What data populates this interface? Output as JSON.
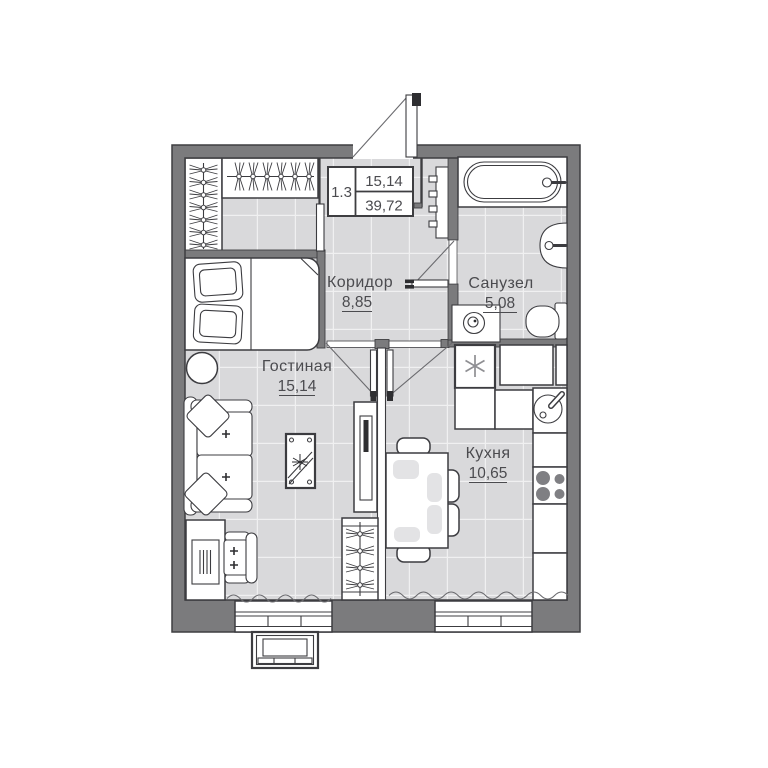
{
  "title": "Apartment floor plan 1.3",
  "stamp": {
    "unit": "1.3",
    "room_area": "15,14",
    "total_area": "39,72"
  },
  "rooms": {
    "corridor": {
      "name": "Коридор",
      "area": "8,85"
    },
    "bathroom": {
      "name": "Санузел",
      "area": "5,08"
    },
    "living_room": {
      "name": "Гостиная",
      "area": "15,14"
    },
    "kitchen": {
      "name": "Кухня",
      "area": "10,65"
    }
  },
  "colors": {
    "wall": "#7b7b7d",
    "wall_outline": "#3e3e41",
    "floor": "#d9d9db",
    "floor_grid": "#ffffff",
    "furniture_fill": "#ffffff",
    "furniture_outline": "#3c3c40",
    "placemat": "#e3e3e5",
    "handle_dark": "#2e2e31",
    "text": "#4b4b4f",
    "background": "#ffffff"
  },
  "furniture_icons": [
    "entrance-door",
    "coat-wardrobe",
    "hanger-closet",
    "ladder-rack",
    "bathtub",
    "wall-sink",
    "toilet",
    "washing-machine",
    "bed",
    "round-side-table",
    "sofa",
    "desk",
    "desk-chair",
    "patterned-rug",
    "tv-stand",
    "hanger-wardrobe",
    "fridge-snowflake",
    "kitchen-cabinets",
    "kitchen-sink",
    "stove-burners",
    "dining-table",
    "dining-chairs",
    "window",
    "air-conditioner",
    "curtain-wave"
  ]
}
